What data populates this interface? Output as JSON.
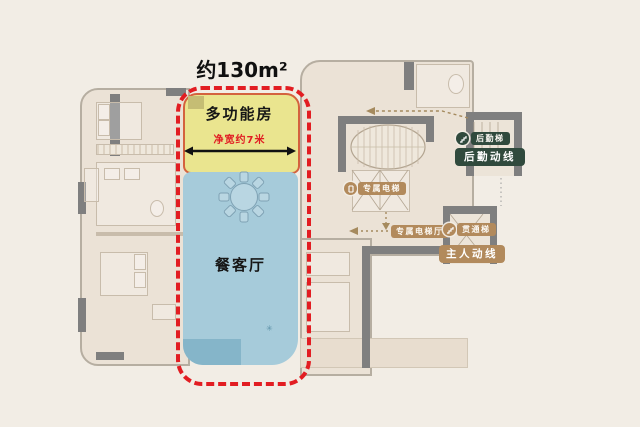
{
  "title": {
    "area_label": "约130m²"
  },
  "highlight": {
    "multi_function_room": "多功能房",
    "width_note": "净宽约7米",
    "dining_living_room": "餐客厅"
  },
  "badges": {
    "service_stairs": "后勤梯",
    "service_route": "后勤动线",
    "private_elevator": "专属电梯",
    "private_elevator_hall": "专属电梯厅",
    "through_stairs": "贯通梯",
    "owner_route": "主人动线"
  },
  "icons": {
    "service_stairs": "stairs-icon",
    "through_stairs": "stairs-icon",
    "private_elevator": "elevator-icon",
    "dining_table": "dining-table-icon",
    "width_arrow": "double-arrow-icon"
  },
  "colors": {
    "bg": "#f2ede5",
    "plan-fill": "#ebe2d6",
    "plan-line": "#b6aea1",
    "wall": "#7f7f7f",
    "highlight-red": "#e21d22",
    "room-yellow": "#eae58f",
    "yellow-edge": "#d4623e",
    "room-blue": "#a6cbda",
    "blue-dark": "#85b5c9",
    "badge-green": "#304a3d",
    "badge-tan": "#b28a5c",
    "route-tan": "#a58a5e",
    "note-red": "#e11d23"
  }
}
